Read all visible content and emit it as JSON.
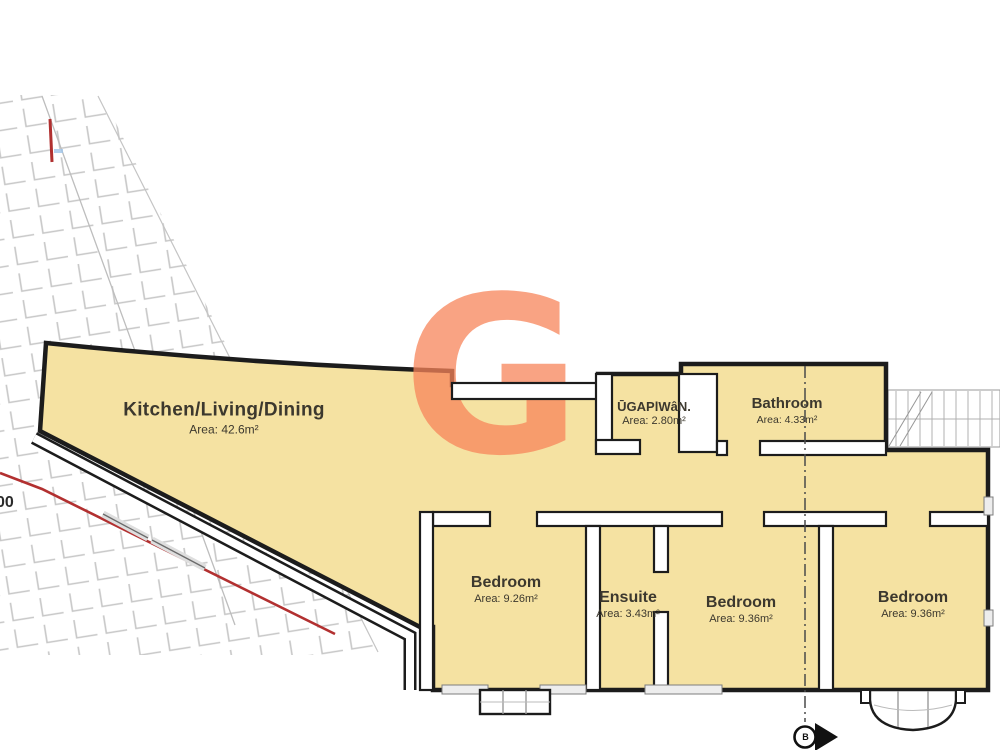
{
  "title": "Apartment floor plan",
  "watermark": {
    "letter": "G",
    "color": "#F8855A"
  },
  "rooms": [
    {
      "name": "Kitchen/Living/Dining",
      "area": "Area: 42.6m²"
    },
    {
      "name": "ŪGAPlWâN.",
      "area": "Area: 2.80m²"
    },
    {
      "name": "Bathroom",
      "area": "Area: 4.33m²"
    },
    {
      "name": "Bedroom",
      "area": "Area: 9.26m²"
    },
    {
      "name": "Ensuite",
      "area": "Area: 3.43m²"
    },
    {
      "name": "Bedroom",
      "area": "Area: 9.36m²"
    },
    {
      "name": "Bedroom",
      "area": "Area: 9.36m²"
    }
  ],
  "annotations": {
    "dimension_fragment": "00",
    "section_marker": "B"
  },
  "colors": {
    "floor_fill": "#F5E2A2",
    "wall_stroke": "#1C1C1C",
    "red_line": "#B23030",
    "hatch_gray": "#C7C7C7"
  }
}
